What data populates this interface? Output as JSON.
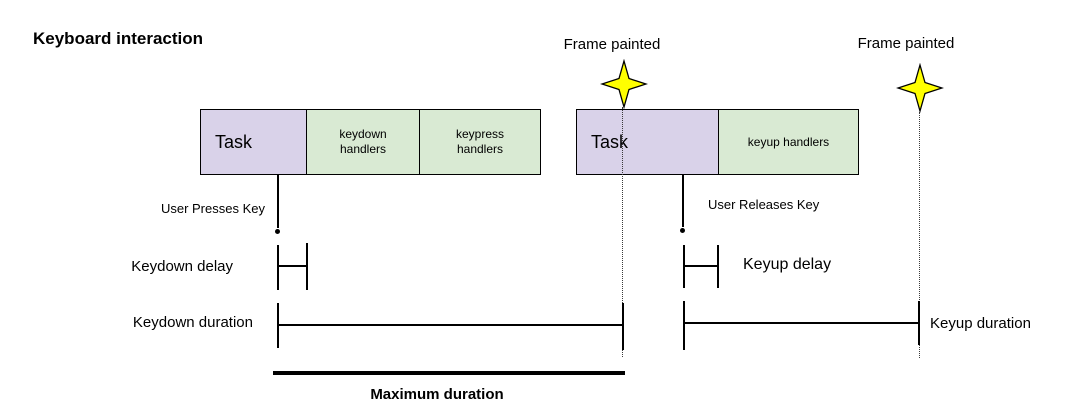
{
  "title": "Keyboard interaction",
  "colors": {
    "task_fill": "#d9d2e9",
    "handlers_fill": "#d9ead3",
    "star_fill": "#ffff00",
    "line": "#000000"
  },
  "frame_markers": [
    {
      "label": "Frame painted",
      "icon": "star-icon"
    },
    {
      "label": "Frame painted",
      "icon": "star-icon"
    }
  ],
  "keydown_track": {
    "task_label": "Task",
    "handler_blocks": [
      "keydown handlers",
      "keypress handlers"
    ],
    "event_label": "User Presses Key",
    "delay_label": "Keydown delay",
    "duration_label": "Keydown duration"
  },
  "keyup_track": {
    "task_label": "Task",
    "handler_blocks": [
      "keyup handlers"
    ],
    "event_label": "User Releases Key",
    "delay_label": "Keyup delay",
    "duration_label": "Keyup duration"
  },
  "maximum_duration_label": "Maximum duration"
}
